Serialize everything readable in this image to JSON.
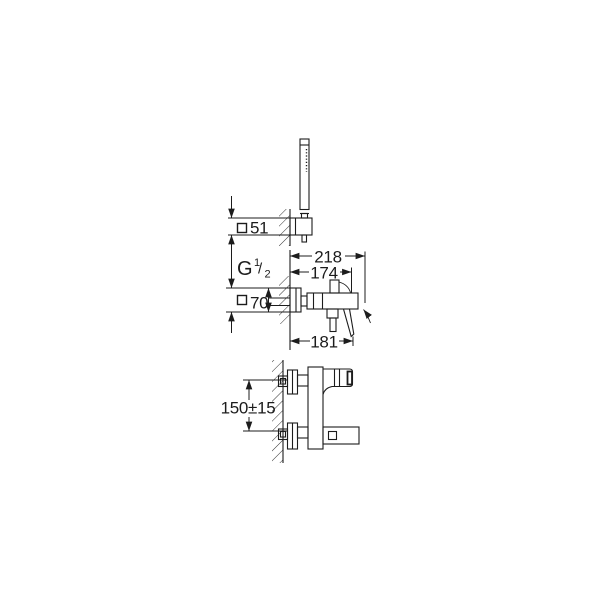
{
  "background": "#ffffff",
  "line_color": "#1c1c1c",
  "labels": {
    "dim_holder_square": "51",
    "dim_escutcheon_square": "70",
    "dim_depth_total": "218",
    "dim_depth_body": "174",
    "dim_depth_lever": "181",
    "dim_connection_height": "150±15",
    "thread_g": "G",
    "thread_numerator": "1",
    "thread_slash": "/",
    "thread_denominator": "2"
  },
  "symbols": {
    "square_section": "□"
  },
  "views": {
    "top": "hand-shower-on-wall-holder",
    "middle": "mixer-side-projection-with-depth-dimensions",
    "bottom": "mixer-front-projection-with-connection-height"
  }
}
